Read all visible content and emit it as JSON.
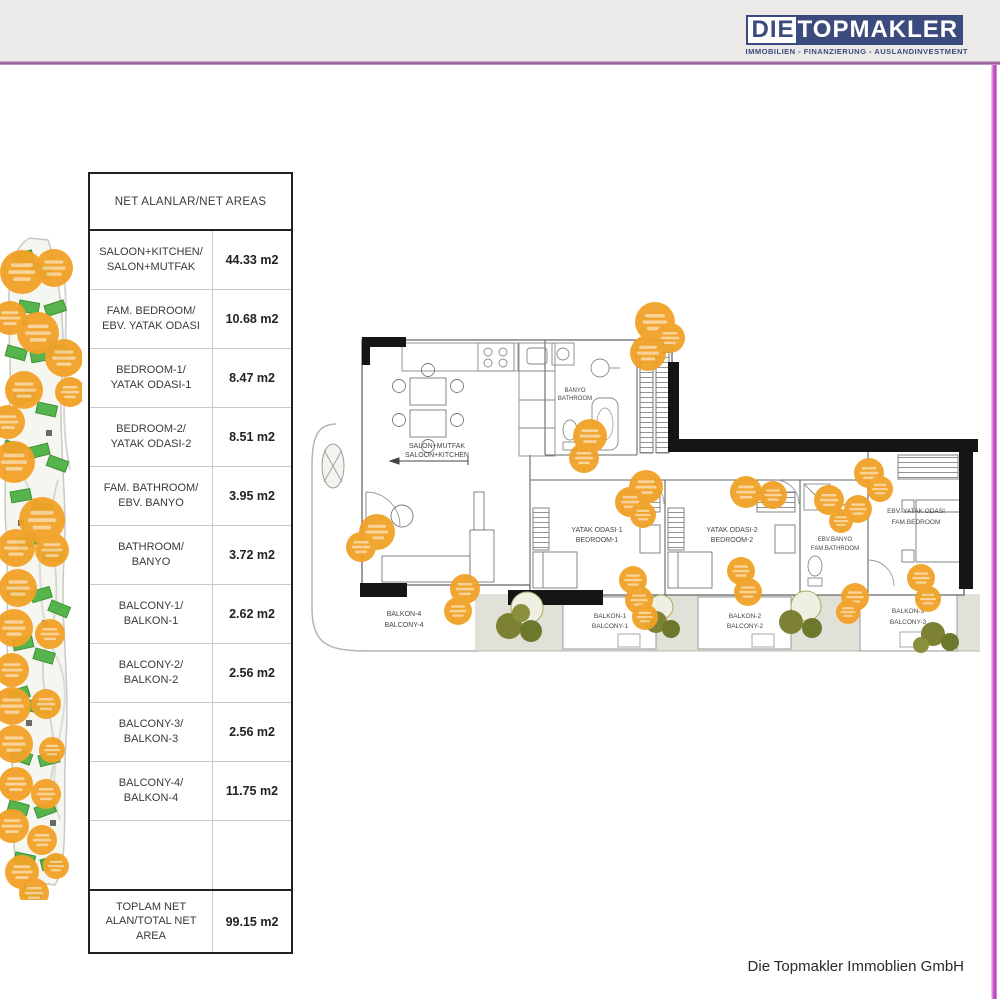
{
  "header": {
    "logo": {
      "die": "DIE",
      "topmakler": "TOPMAKLER",
      "tagline": "IMMOBILIEN - FINANZIERUNG - AUSLANDINVESTMENT"
    }
  },
  "areas_table": {
    "title": "NET ALANLAR/NET AREAS",
    "rows": [
      {
        "l1": "SALOON+KITCHEN/",
        "l2": "SALON+MUTFAK",
        "value": "44.33 m2"
      },
      {
        "l1": "FAM. BEDROOM/",
        "l2": "EBV. YATAK ODASI",
        "value": "10.68 m2"
      },
      {
        "l1": "BEDROOM-1/",
        "l2": "YATAK ODASI-1",
        "value": "8.47 m2"
      },
      {
        "l1": "BEDROOM-2/",
        "l2": "YATAK ODASI-2",
        "value": "8.51 m2"
      },
      {
        "l1": "FAM. BATHROOM/",
        "l2": "EBV. BANYO",
        "value": "3.95 m2"
      },
      {
        "l1": "BATHROOM/",
        "l2": "BANYO",
        "value": "3.72 m2"
      },
      {
        "l1": "BALCONY-1/",
        "l2": "BALKON-1",
        "value": "2.62 m2"
      },
      {
        "l1": "BALCONY-2/",
        "l2": "BALKON-2",
        "value": "2.56 m2"
      },
      {
        "l1": "BALCONY-3/",
        "l2": "BALKON-3",
        "value": "2.56 m2"
      },
      {
        "l1": "BALCONY-4/",
        "l2": "BALKON-4",
        "value": "11.75 m2"
      }
    ],
    "total": {
      "l1": "TOPLAM NET",
      "l2": "ALAN/TOTAL NET",
      "l3": "AREA",
      "value": "99.15 m2"
    }
  },
  "floor_plan": {
    "rooms": {
      "salon": {
        "tr": "SALON+MUTFAK",
        "en": "SALOON+KITCHEN"
      },
      "bathroom": {
        "tr": "BANYO",
        "en": "BATHROOM"
      },
      "bedroom1": {
        "tr": "YATAK ODASI-1",
        "en": "BEDROOM-1"
      },
      "bedroom2": {
        "tr": "YATAK ODASI-2",
        "en": "BEDROOM-2"
      },
      "fam_bathroom": {
        "tr": "EBV.BANYO",
        "en": "FAM.BATHROOM"
      },
      "fam_bedroom": {
        "tr": "EBV. YATAK ODASI",
        "en": "FAM.BEDROOM"
      },
      "balcony1": {
        "tr": "BALKON-1",
        "en": "BALCONY-1"
      },
      "balcony2": {
        "tr": "BALKON-2",
        "en": "BALCONY-2"
      },
      "balcony3": {
        "tr": "BALKON-3",
        "en": "BALCONY-3"
      },
      "balcony4": {
        "tr": "BALKON-4",
        "en": "BALCONY-4"
      }
    }
  },
  "footer": {
    "company": "Die Topmakler Immoblien GmbH"
  },
  "colors": {
    "header_bg": "#ECEAE8",
    "brand_blue": "#3C4B7E",
    "magenta_border": "#C94FC9",
    "watermark_orange": "#F2A227",
    "tree_olive": "#7C8134",
    "site_green": "#56B44C",
    "wall_black": "#151515"
  }
}
